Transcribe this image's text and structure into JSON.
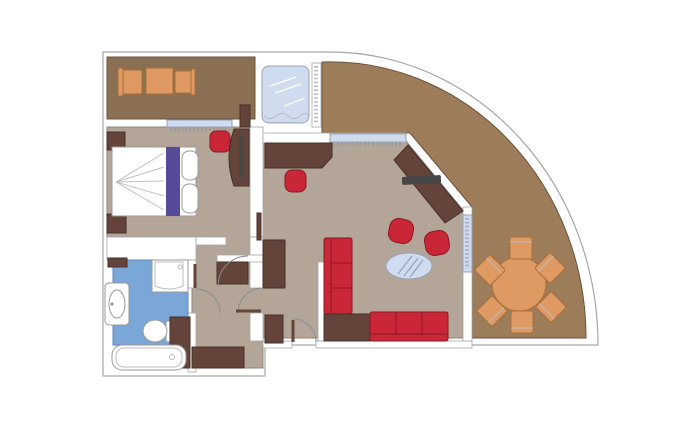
{
  "title": "Suite floor plan with curved private terrace",
  "colors": {
    "background": "#ffffff",
    "outline": "#a6a6a6",
    "wall_fill": "#ffffff",
    "floor_indoor": "#b3a698",
    "floor_edge": "#8f8478",
    "floor_balcony": "#8a6f52",
    "floor_terrace": "#9c7c59",
    "outdoor_edge": "#6c543c",
    "floor_bathroom": "#7ba6d8",
    "bath_edge": "#5d87bd",
    "furniture_dark": "#64443a",
    "furniture_dark_edge": "#46302a",
    "furniture_red": "#c92637",
    "furniture_red_edge": "#8e1726",
    "furniture_orange": "#df9a64",
    "furniture_orange_edge": "#a86f3a",
    "glass_blue": "#cfdbee",
    "glass_stroke": "#97a2b8",
    "bed_white": "#ffffff",
    "bed_purple": "#574a9b",
    "tv_dark": "#474747",
    "hatch": "#8d8f9d",
    "door_arc": "#8b8b8b",
    "fixture_edge": "#9a9a9a"
  },
  "rooms": [
    {
      "id": "balcony",
      "name": "bedroom-balcony",
      "floor": "balcony",
      "furniture": [
        "balcony-chair-left",
        "balcony-table",
        "balcony-chair-right"
      ]
    },
    {
      "id": "whirlpool-deck",
      "name": "whirlpool-deck",
      "floor": "wall_fill",
      "furniture": [
        "glass-whirlpool",
        "glazed-wall"
      ]
    },
    {
      "id": "terrace",
      "name": "curved-terrace",
      "floor": "terrace",
      "furniture": [
        "round-dining-table",
        "terrace-chair-1",
        "terrace-chair-2",
        "terrace-chair-3",
        "terrace-chair-4",
        "terrace-chair-5",
        "terrace-chair-6"
      ]
    },
    {
      "id": "bedroom",
      "name": "bedroom",
      "floor": "indoor",
      "furniture": [
        "double-bed",
        "bed-runner",
        "pillows",
        "nightstand-top",
        "nightstand-bottom",
        "bedroom-desk",
        "bedroom-tv",
        "bedroom-desk-chair",
        "bedroom-window"
      ]
    },
    {
      "id": "bathroom",
      "name": "bathroom",
      "floor": "bathroom",
      "furniture": [
        "shower",
        "washbasin",
        "toilet",
        "bathtub",
        "bath-cabinet",
        "bath-shelf"
      ]
    },
    {
      "id": "hallway",
      "name": "entry-hallway",
      "floor": "indoor",
      "furniture": [
        "wardrobe-center",
        "wardrobe-east",
        "wardrobe-south",
        "entry-door",
        "interior-doors"
      ]
    },
    {
      "id": "living-room",
      "name": "living-room",
      "floor": "indoor",
      "furniture": [
        "writing-desk",
        "desk-chair",
        "corner-tv-cabinet",
        "tv-panel",
        "armchair-1",
        "armchair-2",
        "oval-glass-table",
        "sofa-vertical",
        "corner-side-table",
        "sofa-horizontal",
        "living-window",
        "sliding-terrace-door"
      ]
    }
  ]
}
